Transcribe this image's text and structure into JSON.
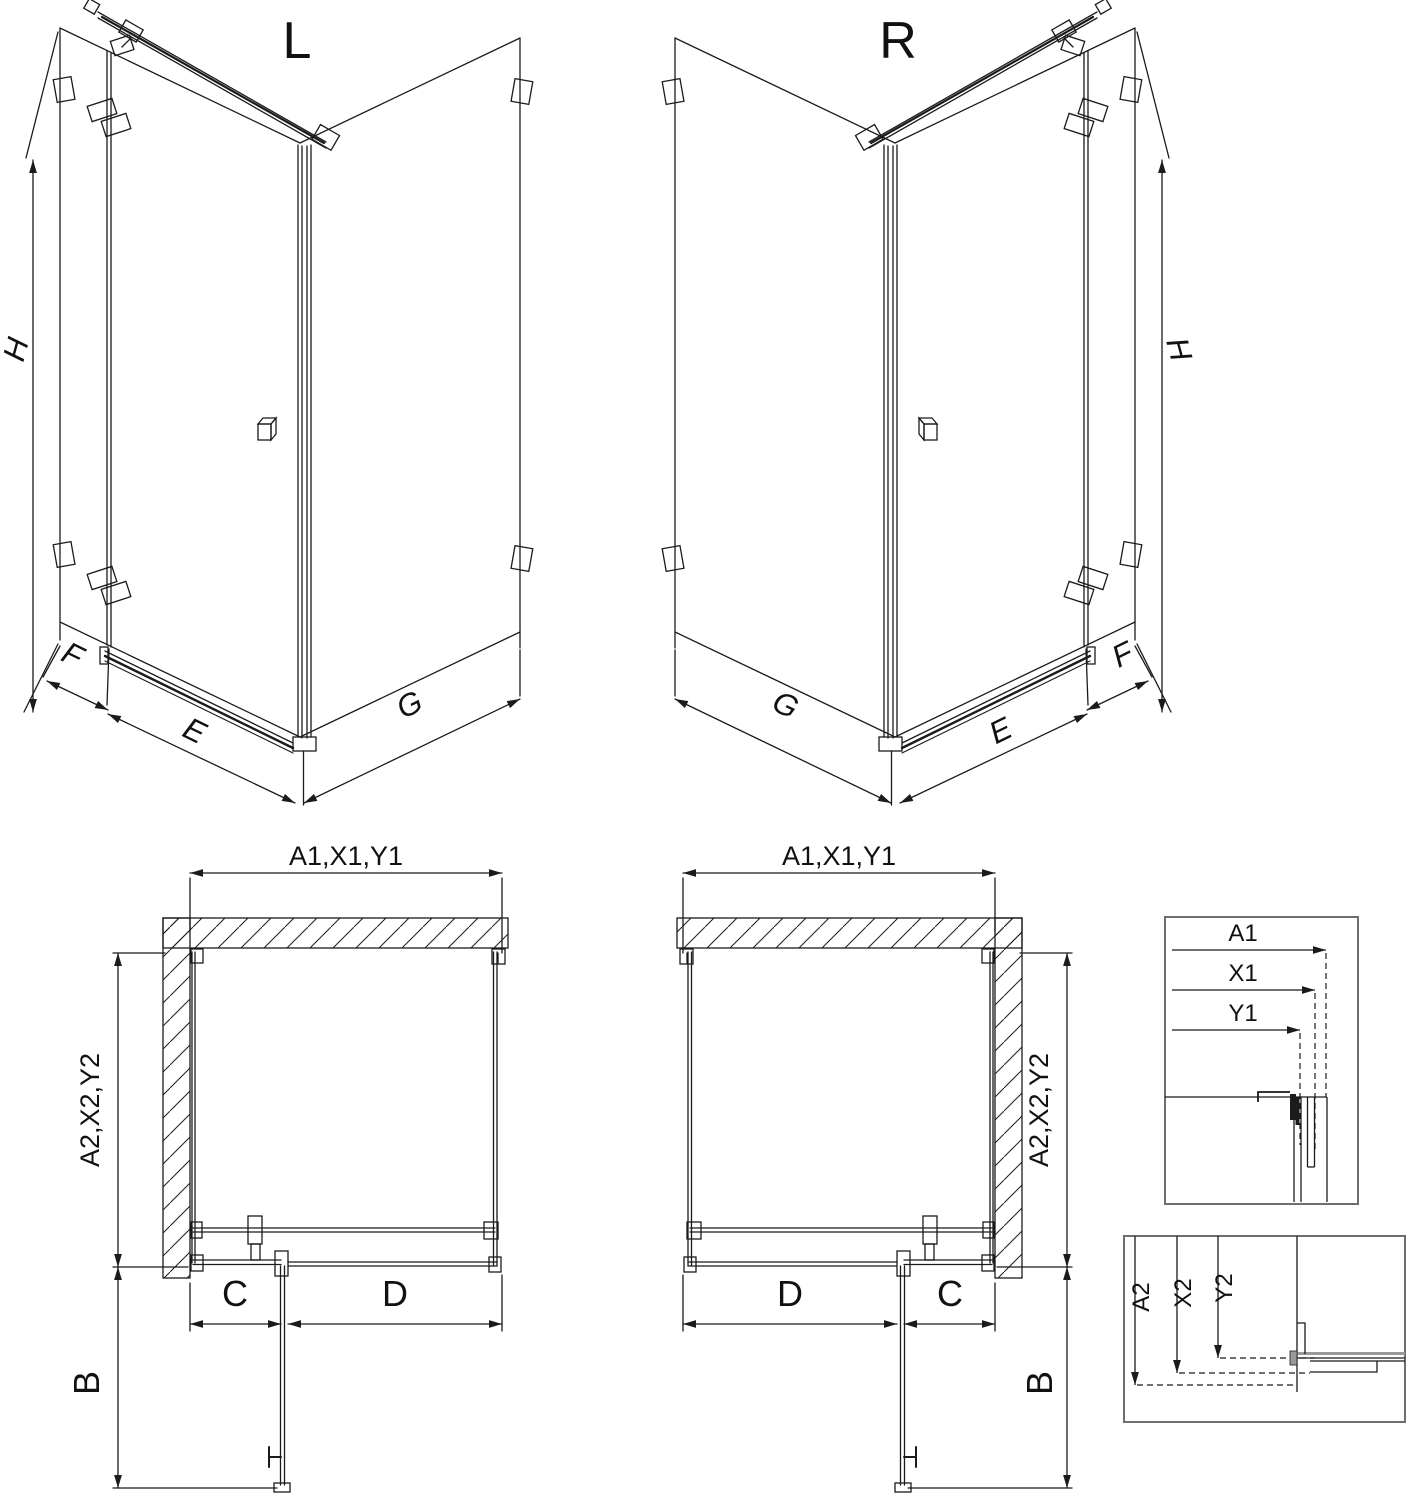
{
  "iso_left": {
    "view_label": "L",
    "dim_height": "H",
    "dim_fixed_panel": "F",
    "dim_door": "E",
    "dim_return_panel": "G"
  },
  "iso_right": {
    "view_label": "R",
    "dim_height": "H",
    "dim_fixed_panel": "F",
    "dim_door": "E",
    "dim_return_panel": "G"
  },
  "plan_left": {
    "dim_width": "A1,X1,Y1",
    "dim_depth": "A2,X2,Y2",
    "dim_fixed_segment": "C",
    "dim_door_opening": "D",
    "dim_door_projection": "B"
  },
  "plan_right": {
    "dim_width": "A1,X1,Y1",
    "dim_depth": "A2,X2,Y2",
    "dim_fixed_segment": "C",
    "dim_door_opening": "D",
    "dim_door_projection": "B"
  },
  "detail_widths": {
    "a1": "A1",
    "x1": "X1",
    "y1": "Y1"
  },
  "detail_depths": {
    "a2": "A2",
    "x2": "X2",
    "y2": "Y2"
  },
  "colors": {
    "line": "#1b1b1b",
    "detail_border": "#6e6e6e",
    "profile_gray": "#999999",
    "background": "#ffffff"
  }
}
